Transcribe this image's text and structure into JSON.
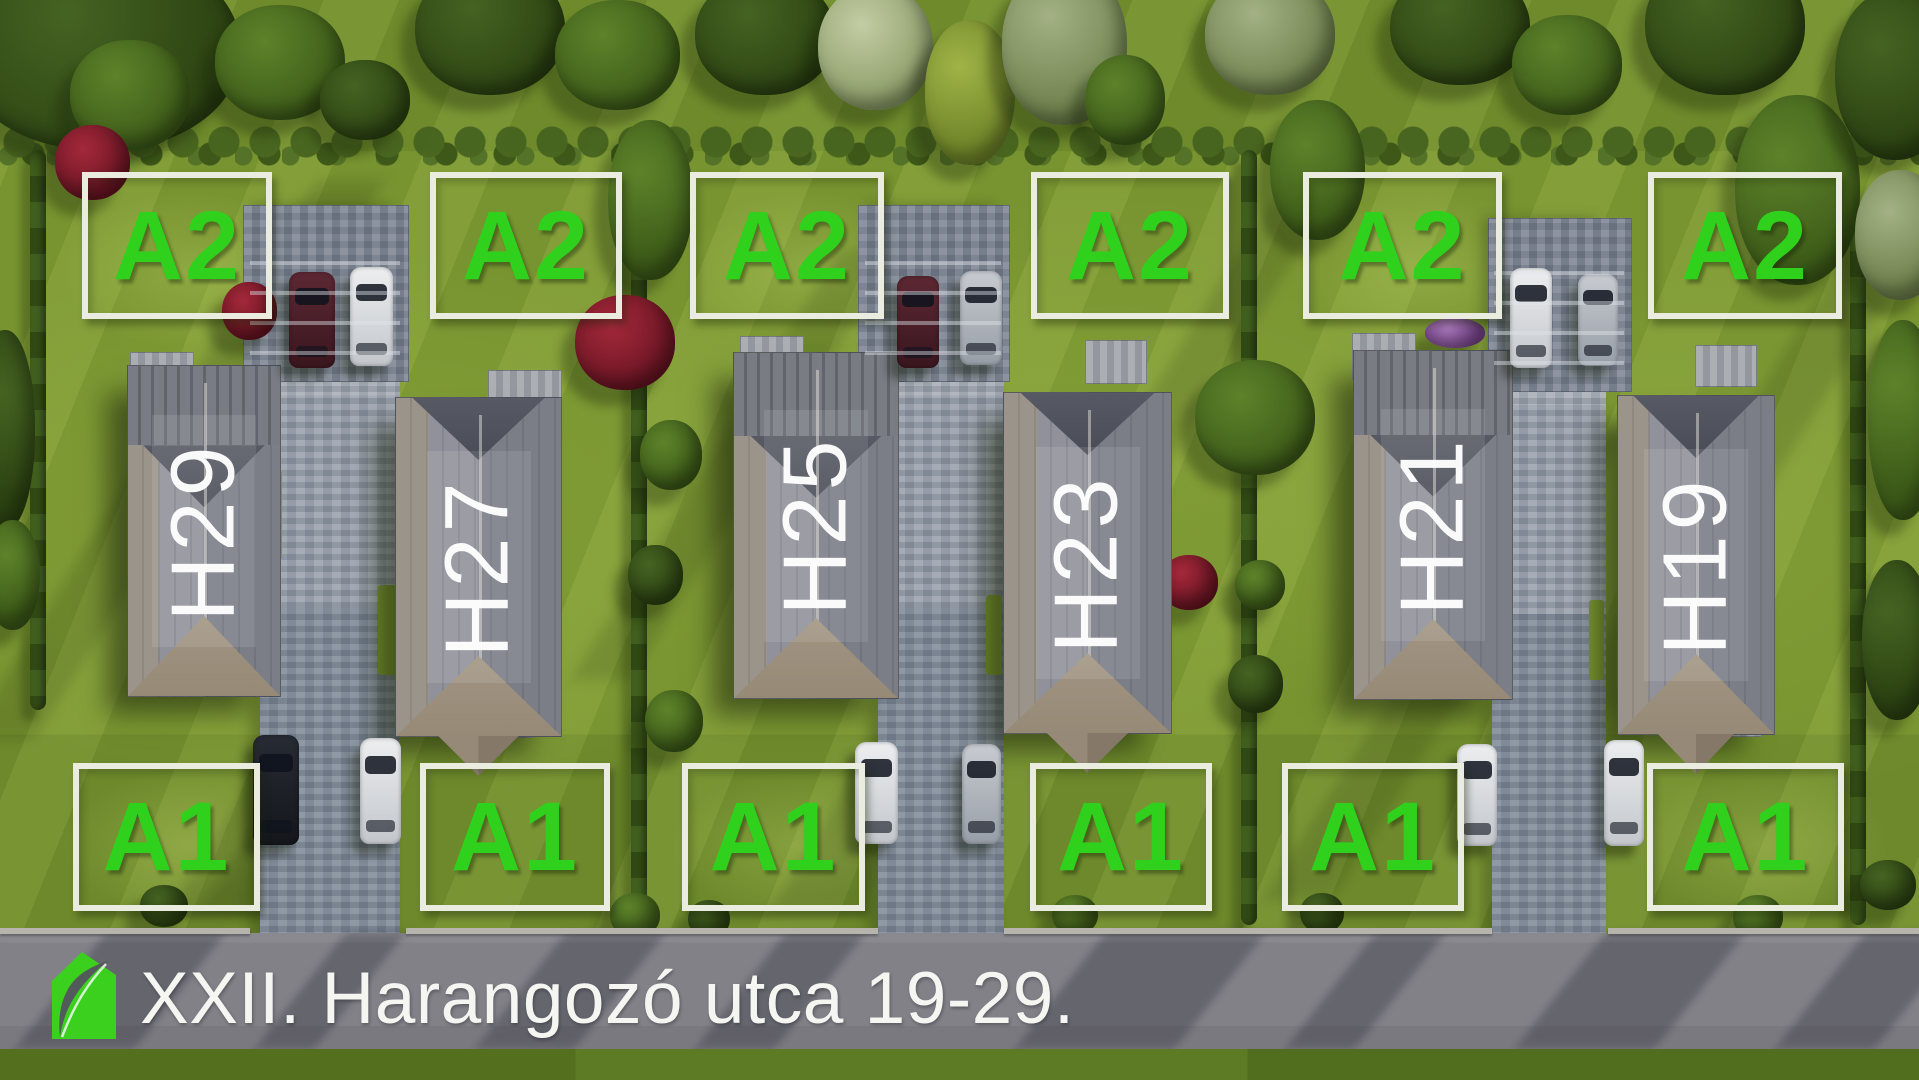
{
  "scene_type": "aerial-residential-site-plan",
  "address_bar": {
    "text": "XXII. Harangozó utca 19-29."
  },
  "logo": {
    "icon": "green-house-leaf-logo",
    "color": "#3bd01e"
  },
  "houses": [
    {
      "label": "H29"
    },
    {
      "label": "H27"
    },
    {
      "label": "H25"
    },
    {
      "label": "H23"
    },
    {
      "label": "H21"
    },
    {
      "label": "H19"
    }
  ],
  "back_plots": [
    {
      "label": "A2"
    },
    {
      "label": "A2"
    },
    {
      "label": "A2"
    },
    {
      "label": "A2"
    },
    {
      "label": "A2"
    },
    {
      "label": "A2"
    }
  ],
  "front_plots": [
    {
      "label": "A1"
    },
    {
      "label": "A1"
    },
    {
      "label": "A1"
    },
    {
      "label": "A1"
    },
    {
      "label": "A1"
    },
    {
      "label": "A1"
    }
  ],
  "colors": {
    "plot_label_green": "#2fd11c",
    "plot_border_white": "#e9ecdf",
    "house_label_white": "#ffffff",
    "road_gray": "#828188",
    "grass_green": "#7e9a33"
  }
}
